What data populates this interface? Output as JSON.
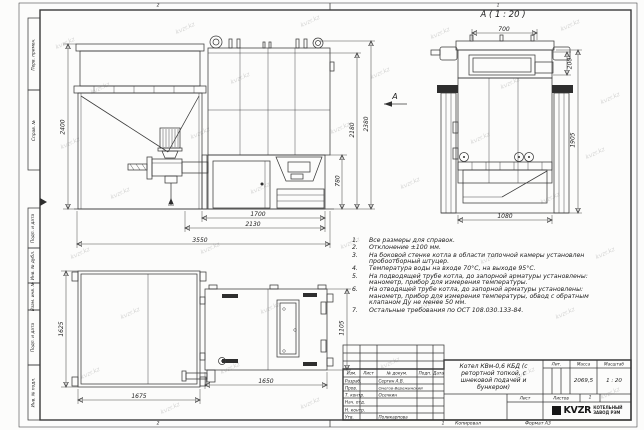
{
  "watermark": "kvzr.kz",
  "frame": {
    "margin_labels": [
      "Перв. примен.",
      "Справ. №",
      "Подп. и дата",
      "Инв. № дубл.",
      "Взам. инв. №",
      "Подп. и дата",
      "Инв. № подл."
    ],
    "zones_top": [
      "2",
      "1"
    ],
    "zones_bottom": [
      "2",
      "1"
    ],
    "copied": "Копировал",
    "format": "Формат А3"
  },
  "detail_view": {
    "title": "А ( 1 : 20 )",
    "arrow_label": "А"
  },
  "dims": {
    "front": {
      "bunker_height": "2400",
      "total_height": "2380",
      "body_height": "2180",
      "furnace_height": "780",
      "furnace_width": "1700",
      "boiler_width": "2130",
      "total_width": "3550"
    },
    "detail": {
      "top_width": "700",
      "collar_height": "200",
      "body_height": "1905",
      "base_width": "1080"
    },
    "plan": {
      "bunker_depth": "1625",
      "bunker_width": "1675",
      "boiler_length": "1650",
      "boiler_depth": "1105"
    }
  },
  "notes": {
    "items": [
      {
        "num": "1.",
        "text": "Все размеры для справок."
      },
      {
        "num": "2.",
        "text": "Отклонение ±100 мм."
      },
      {
        "num": "3.",
        "text": "На боковой стенке котла в области топочной камеры установлен пробоотборный штуцер."
      },
      {
        "num": "4.",
        "text": "Температура воды на входе 70°С, на выходе 95°С."
      },
      {
        "num": "5.",
        "text": "На подводящей трубе котла, до запорной арматуры установлены: манометр, прибор для измерения температуры."
      },
      {
        "num": "6.",
        "text": "На отводящей трубе котла, до запорной арматуры установлены: манометр, прибор для измерения температуры, обвод с обратным клапаном Ду не менее 50 мм."
      },
      {
        "num": "7.",
        "text": "Остальные требования по ОСТ 108.030.133-84."
      }
    ]
  },
  "title_block": {
    "header": {
      "izm": "Изм.",
      "list": "Лист",
      "doc": "№ докум.",
      "sign": "Подп.",
      "date": "Дата"
    },
    "rows": [
      {
        "role": "Разраб.",
        "name": "Сергин А.В."
      },
      {
        "role": "Пров.",
        "name": "Онегов-Вережинский"
      },
      {
        "role": "Т. контр.",
        "name": "Осечкин"
      },
      {
        "role": "Нач. отд.",
        "name": ""
      },
      {
        "role": "Н. контр.",
        "name": ""
      },
      {
        "role": "Утв.",
        "name": "Поликарпова"
      }
    ],
    "doc_title": "Котел КВм-0,6 КБД (с ретортной топкой, с шнековой подачей и бункером)",
    "lit_label": "Лит.",
    "mass_label": "Масса",
    "scale_label": "Масштаб",
    "mass_value": "2069,5",
    "scale_value": "1 : 20",
    "sheet_label": "Лист",
    "sheets_label": "Листов",
    "sheets_value": "1",
    "logo_text": "KVZR",
    "logo_org_line1": "КОТЕЛЬНЫЙ",
    "logo_org_line2": "ЗАВОД РЭМ"
  }
}
